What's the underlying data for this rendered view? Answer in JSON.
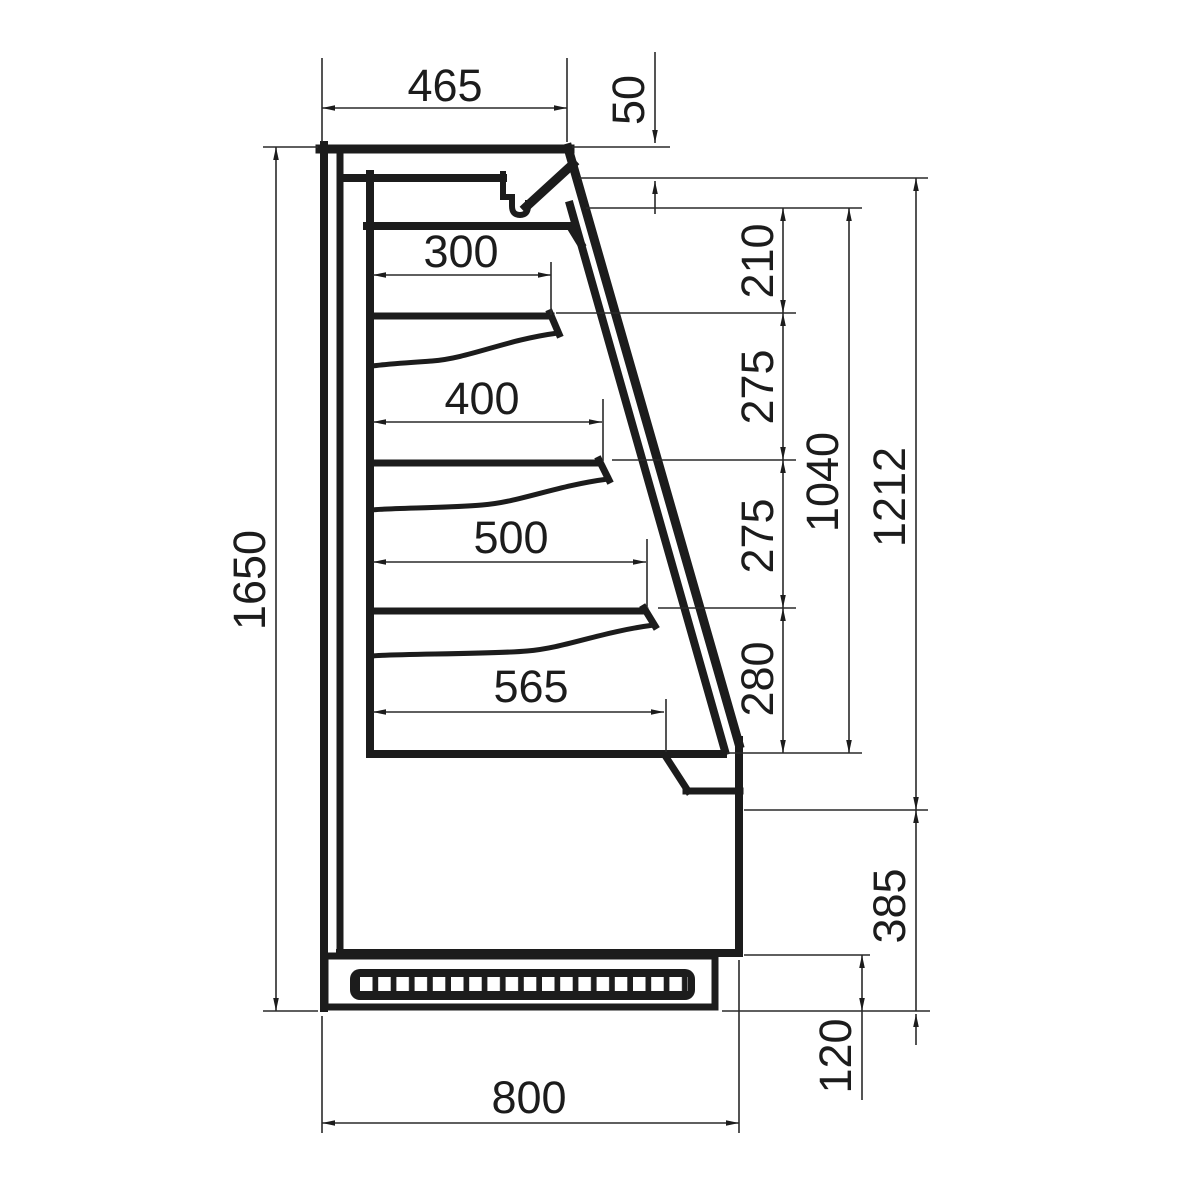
{
  "drawing": {
    "ink_color": "#1c1c1c",
    "background_color": "#ffffff",
    "dims": {
      "top_depth": "465",
      "canopy_front_height": "50",
      "shelf_1_depth": "300",
      "shelf_2_depth": "400",
      "shelf_3_depth": "500",
      "base_deck_depth": "565",
      "spacing_canopy_to_shelf_1": "210",
      "spacing_shelf_1_to_2": "275",
      "spacing_shelf_2_to_3": "275",
      "spacing_shelf_3_to_deck": "280",
      "interior_opening_height": "1040",
      "front_opening_height": "1212",
      "base_section_height": "385",
      "plinth_height": "120",
      "overall_height": "1650",
      "overall_depth": "800"
    }
  }
}
